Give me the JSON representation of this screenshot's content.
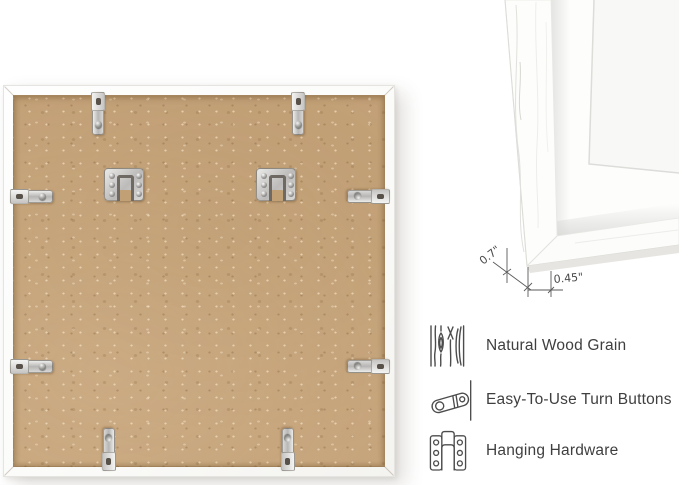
{
  "colors": {
    "background": "#ffffff",
    "backing_board": "#c5a37a",
    "frame_white": "#fcfcfb",
    "metal_hardware": "#c9c9c7",
    "feature_text": "#3f3f3f",
    "dimension_lines": "#5a5a5a"
  },
  "dimension_detail": {
    "depth_label": "0.7\"",
    "face_width_label": "0.45\""
  },
  "features": [
    {
      "icon": "wood-grain-icon",
      "label": "Natural Wood Grain"
    },
    {
      "icon": "turn-button-icon",
      "label": "Easy-To-Use Turn Buttons"
    },
    {
      "icon": "hanging-hardware-icon",
      "label": "Hanging Hardware"
    }
  ]
}
